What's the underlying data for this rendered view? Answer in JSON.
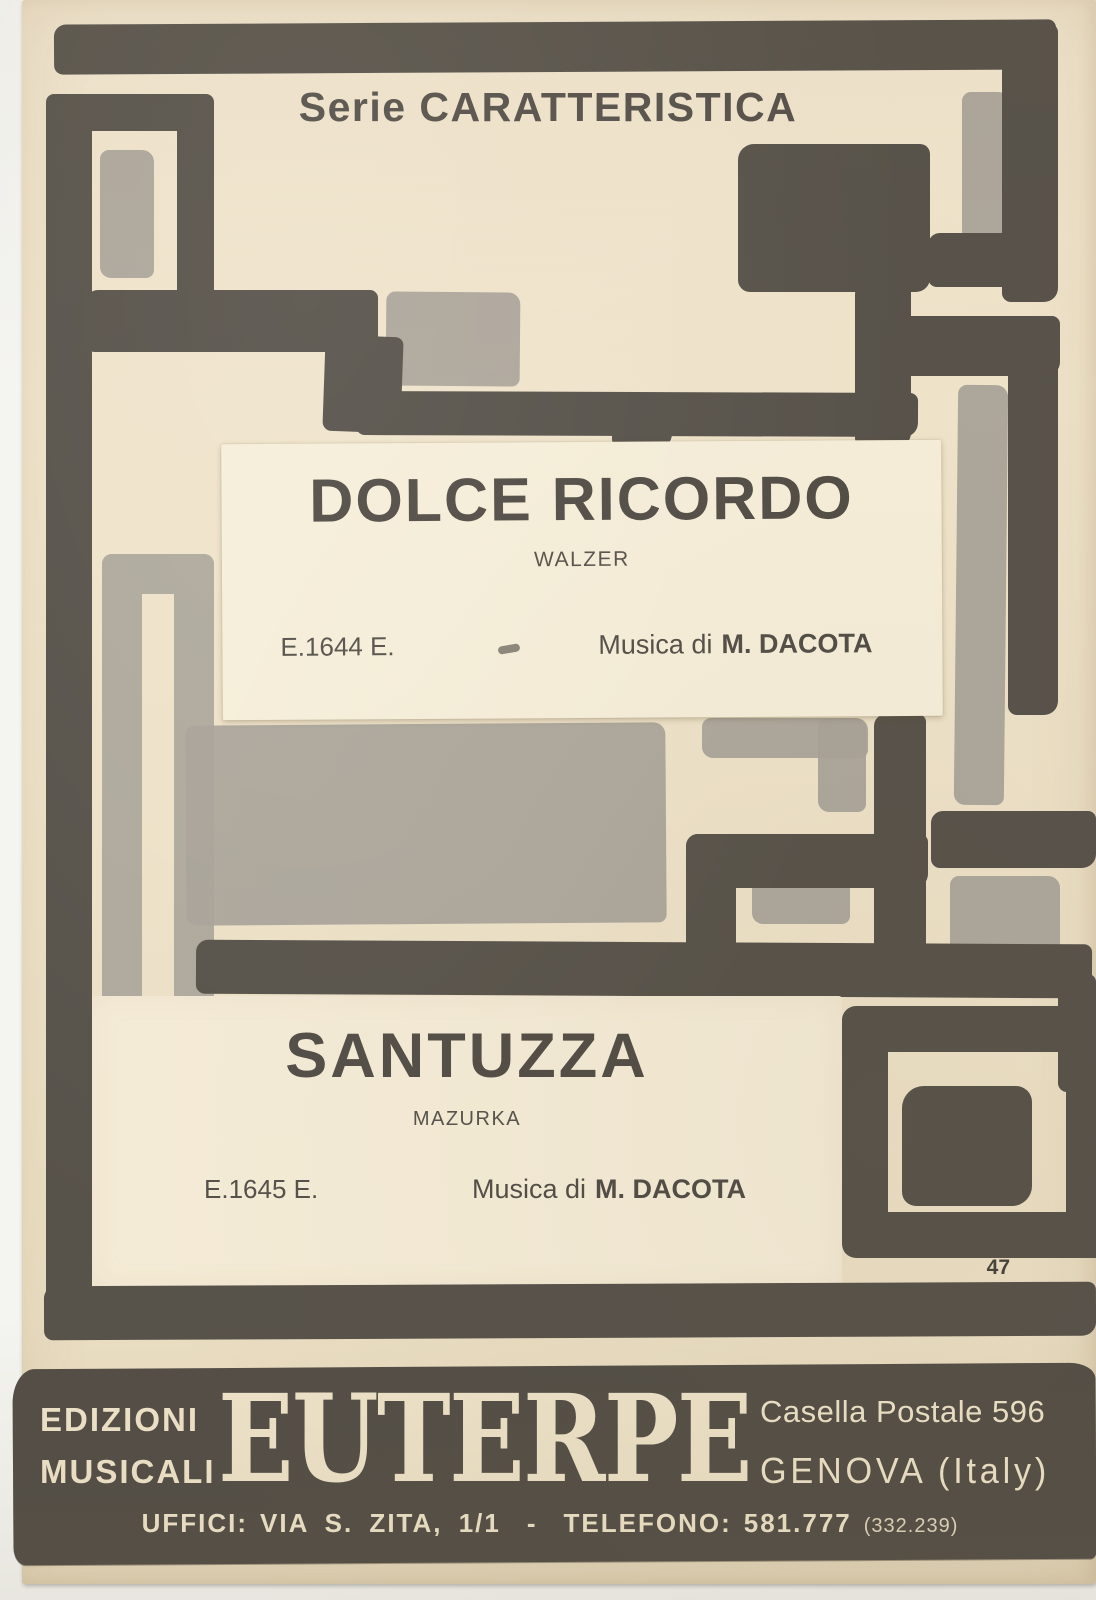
{
  "series_title": "Serie CARATTERISTICA",
  "pieces": [
    {
      "title": "DOLCE RICORDO",
      "subtitle": "WALZER",
      "catalog_number": "E.1644 E.",
      "credit_prefix": "Musica di",
      "composer": "M. DACOTA"
    },
    {
      "title": "SANTUZZA",
      "subtitle": "MAZURKA",
      "catalog_number": "E.1645 E.",
      "credit_prefix": "Musica di",
      "composer": "M. DACOTA"
    }
  ],
  "page_number": "47",
  "publisher": {
    "name_line1": "EDIZIONI",
    "name_line2": "MUSICALI",
    "brand": "EUTERPE",
    "address_line1": "Casella Postale 596",
    "address_line2": "GENOVA (Italy)",
    "offices": {
      "label": "UFFICI:",
      "address": "VIA S. ZITA, 1/1",
      "separator": "-",
      "phone_label": "TELEFONO:",
      "phone": "581.777",
      "phone_alt": "(332.239)"
    }
  },
  "colors": {
    "ink": "#57524a",
    "accent_grey": "#a9a399",
    "paper": "#efe3ca",
    "panel": "#f6eed9",
    "banner": "#534e47",
    "banner_text": "#efe4ca"
  }
}
